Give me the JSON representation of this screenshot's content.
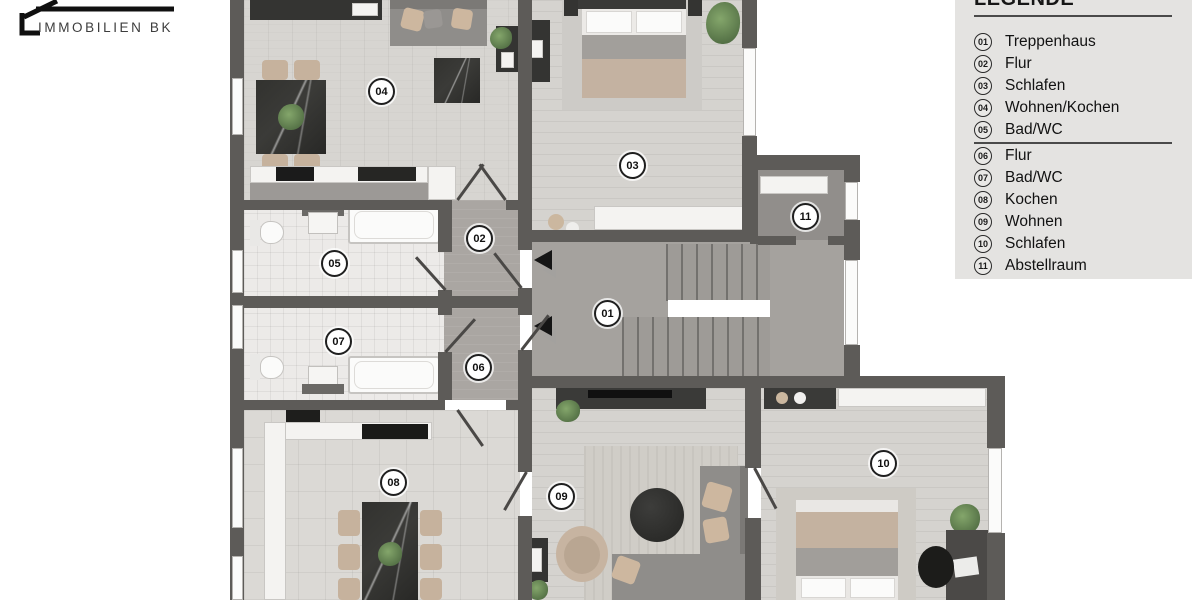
{
  "logo": {
    "company_name": "IMMOBILIEN BK"
  },
  "legend": {
    "title": "LEGENDE",
    "items": [
      {
        "number": "01",
        "label": "Treppenhaus"
      },
      {
        "number": "02",
        "label": "Flur"
      },
      {
        "number": "03",
        "label": "Schlafen"
      },
      {
        "number": "04",
        "label": "Wohnen/Kochen"
      },
      {
        "number": "05",
        "label": "Bad/WC"
      },
      {
        "number": "06",
        "label": "Flur"
      },
      {
        "number": "07",
        "label": "Bad/WC"
      },
      {
        "number": "08",
        "label": "Kochen"
      },
      {
        "number": "09",
        "label": "Wohnen"
      },
      {
        "number": "10",
        "label": "Schlafen"
      },
      {
        "number": "11",
        "label": "Abstellraum"
      }
    ]
  },
  "floorplan": {
    "rooms": [
      {
        "number": "01",
        "name": "Treppenhaus"
      },
      {
        "number": "02",
        "name": "Flur"
      },
      {
        "number": "03",
        "name": "Schlafen"
      },
      {
        "number": "04",
        "name": "Wohnen/Kochen"
      },
      {
        "number": "05",
        "name": "Bad/WC"
      },
      {
        "number": "06",
        "name": "Flur"
      },
      {
        "number": "07",
        "name": "Bad/WC"
      },
      {
        "number": "08",
        "name": "Kochen"
      },
      {
        "number": "09",
        "name": "Wohnen"
      },
      {
        "number": "10",
        "name": "Schlafen"
      },
      {
        "number": "11",
        "name": "Abstellraum"
      }
    ]
  },
  "colors": {
    "wall": "#5d5b58",
    "legend_background": "#e4e3e1",
    "floor_light": "#d5d3cf",
    "floor_hall": "#aaa6a2",
    "badge_border": "#1f1f1f",
    "furniture_dark": "#343432"
  }
}
